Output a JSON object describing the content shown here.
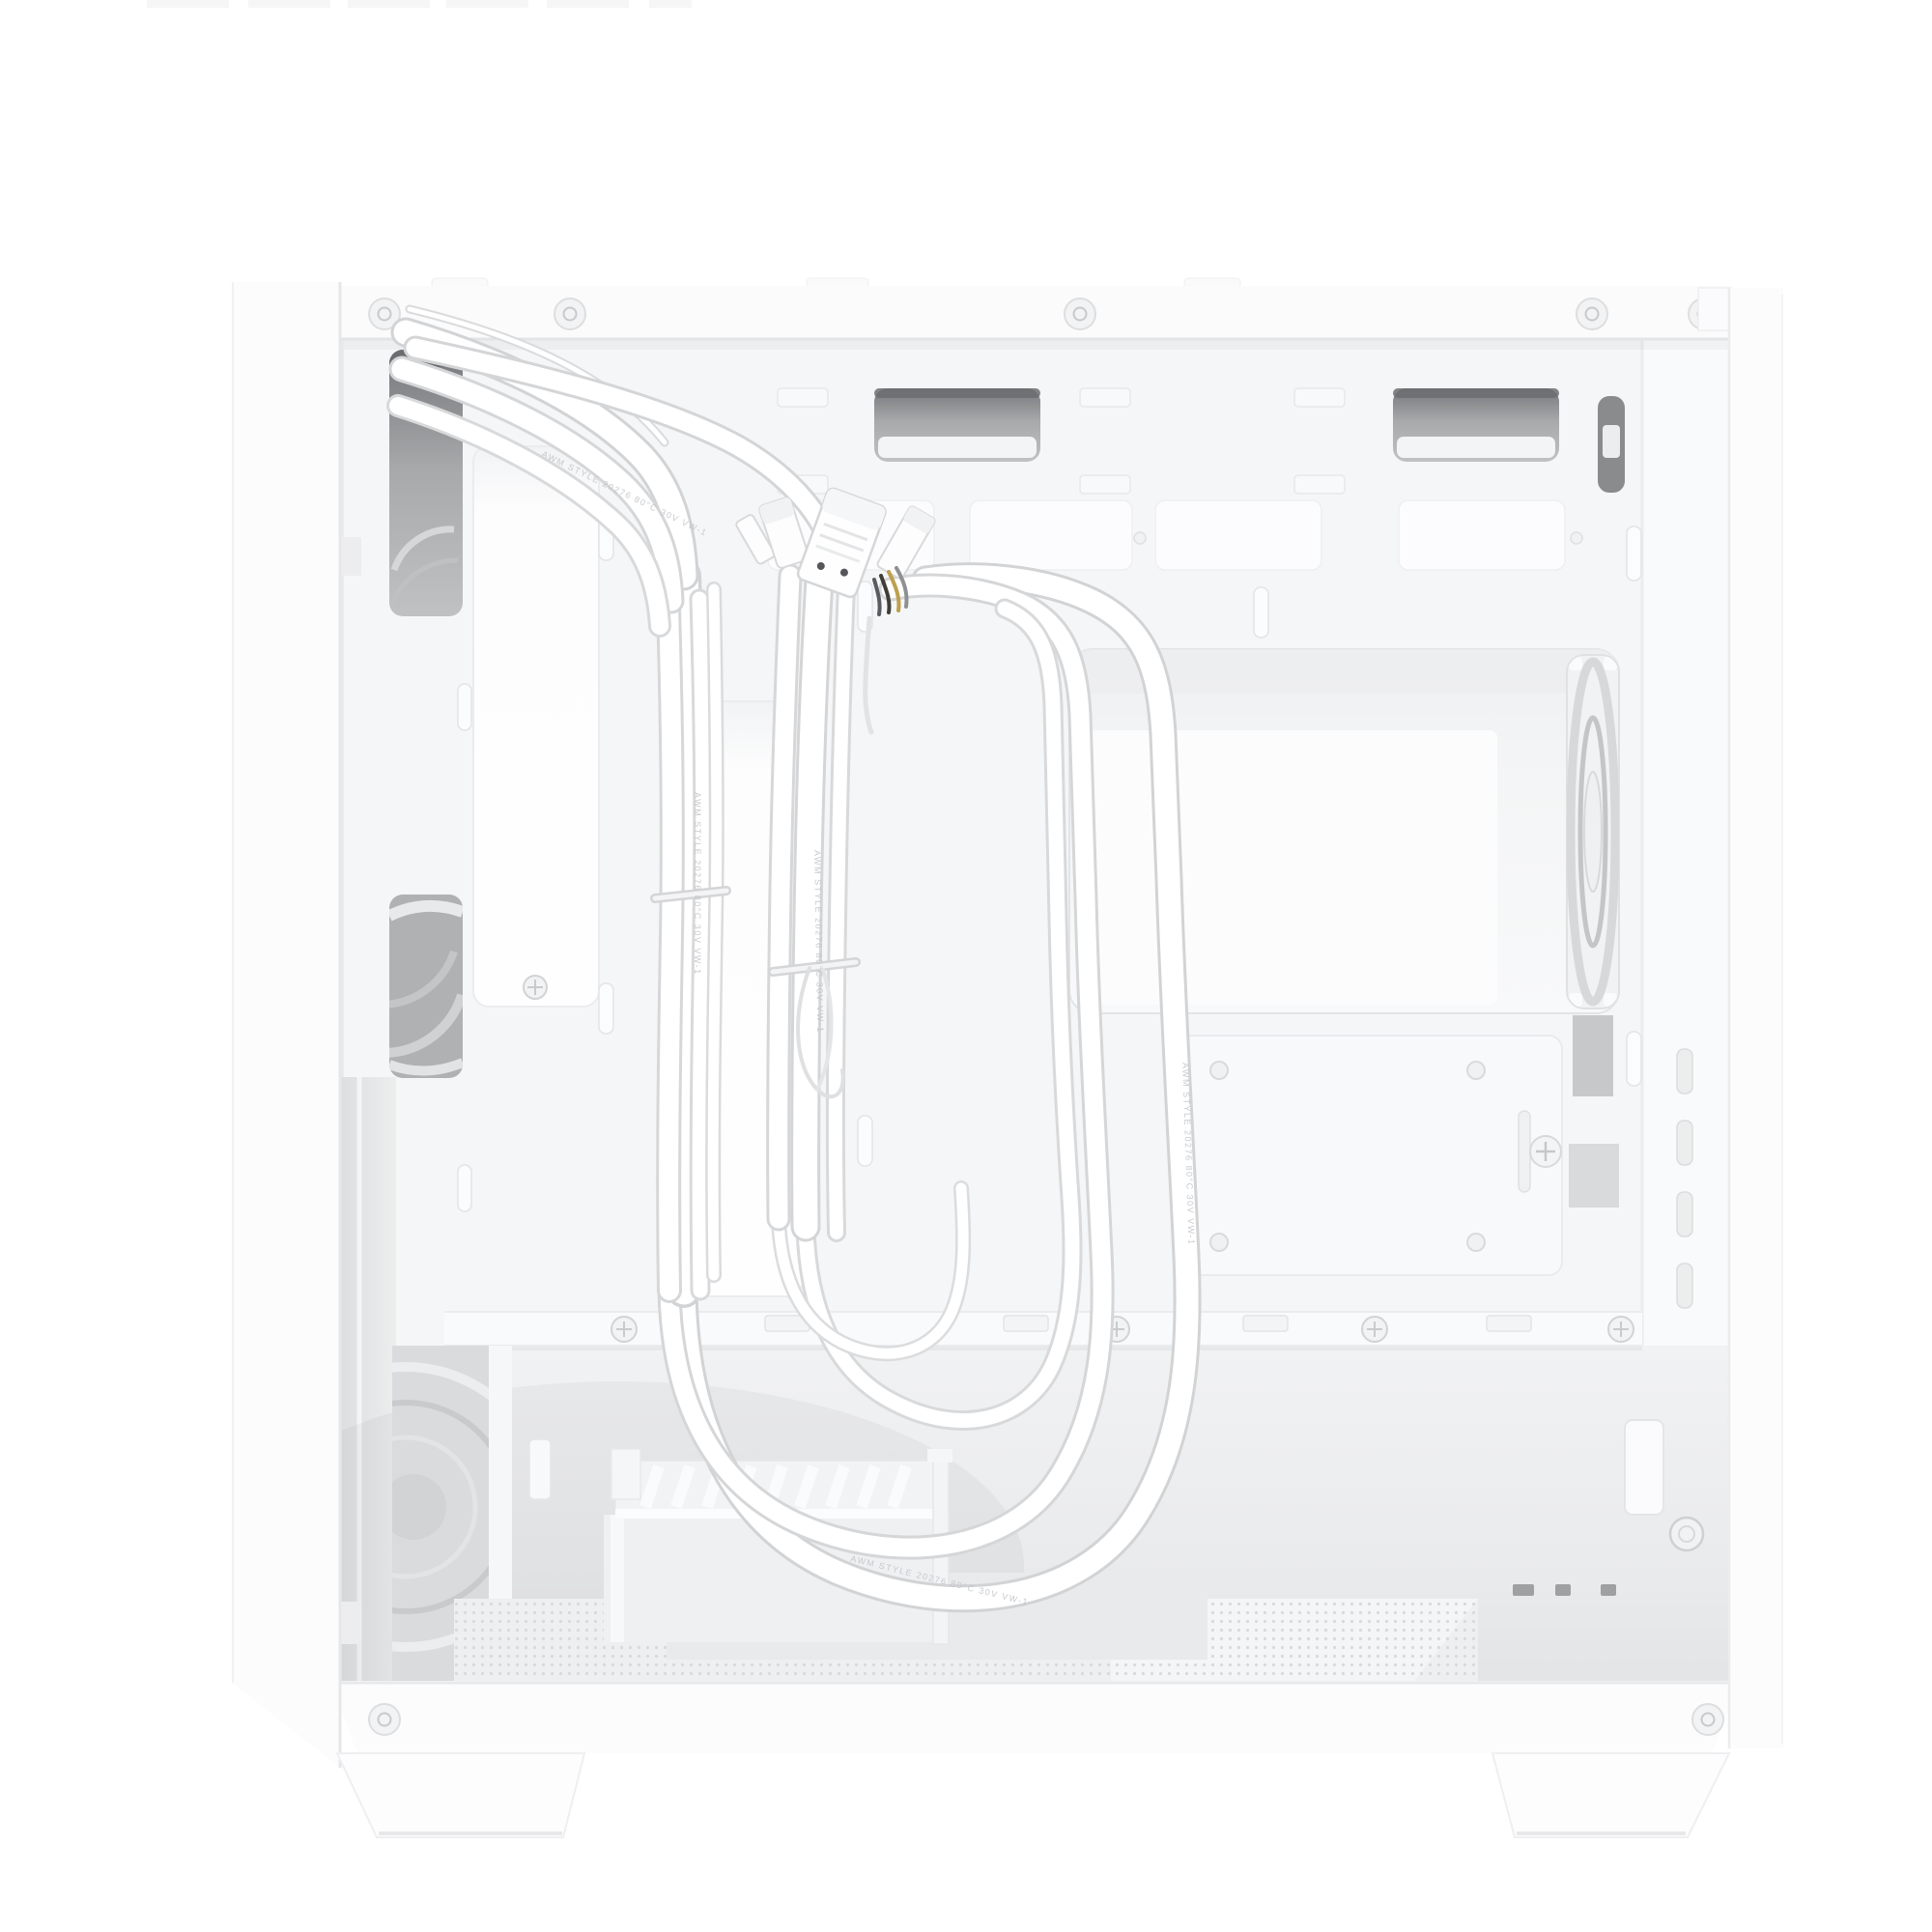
{
  "scene": {
    "type": "product-photo",
    "subject": "White micro-ATX PC tower case with right side panel removed, showing cable-management side",
    "orientation": "front panel at left edge, rear panel at right edge, studio white background"
  },
  "cables": {
    "marking": "AWM STYLE 20276 80°C 30V VW-1",
    "tie_count": 2,
    "connector_names": [
      "front-io-header",
      "usb3-header",
      "hd-audio-header",
      "fan-led-header"
    ]
  },
  "parts": {
    "front_panel_edge": "front panel (edge-on)",
    "rear_panel_edge": "rear panel (edge-on)",
    "top_rail": "top frame rail with rivets",
    "motherboard_tray": "motherboard tray (rear side)",
    "cpu_cutout": "CPU cooler backplate cutout",
    "rear_fan": "rear 120mm exhaust fan (edge view)",
    "front_fans": "front intake fans seen through tray cutouts",
    "ssd_plate": "2.5-inch SSD mounting plate with thumbscrew",
    "drive_cage": "bottom HDD drive cage with vented shelf",
    "mesh_floor": "perforated PSU floor vent",
    "expansion_latches": "expansion-slot fixing slots",
    "feet": "case feet"
  },
  "colors": {
    "background": "#ffffff",
    "panel": "#fcfcfd",
    "panel_edge": "#e7e8ea",
    "rail": "#fbfbfc",
    "tray": "#f5f6f7",
    "tray_right": "#f9fafb",
    "recess": "#fdfdfe",
    "pad": "#fcfcfe",
    "grommet_dark": "#797a7d",
    "grommet_mid": "#a9aaac",
    "lip": "#f3f4f5",
    "cutout_inner": "#fcfcfd",
    "fan_ring": "#d7d8da",
    "fan_hub": "#eff0f2",
    "metal": "#c7c8ca",
    "mesh": "#edeff0",
    "mesh_dot": "#d8dadb",
    "cage": "#f7f8f9",
    "floorplate": "#e9eaec",
    "cable_core": "#ffffff",
    "cable_edge": "#d2d3d5",
    "pin_yellow": "#bda04e",
    "pin_dark": "#3f3d36",
    "artifact": "#f6f6f6"
  }
}
